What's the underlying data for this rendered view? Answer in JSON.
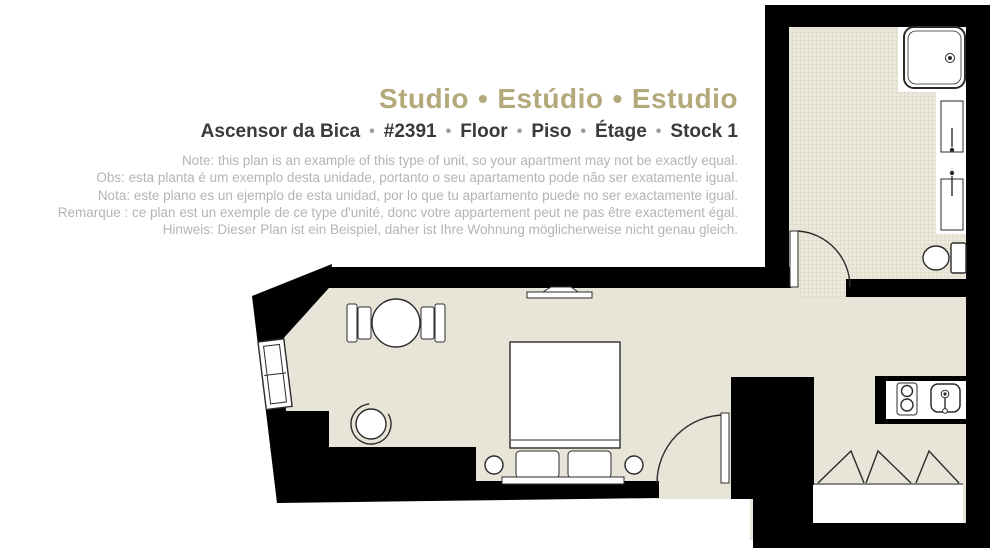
{
  "title": {
    "parts": [
      "Studio",
      "Estúdio",
      "Estudio"
    ],
    "separator": "•"
  },
  "subtitle": {
    "parts": [
      "Ascensor da Bica",
      "#2391",
      "Floor",
      "Piso",
      "Étage",
      "Stock 1"
    ],
    "separator": "•"
  },
  "disclaimer": {
    "lines": [
      "Note: this plan is an example of this type of unit, so your apartment may not be exactly equal.",
      "Obs: esta planta é um exemplo desta unidade, portanto o seu apartamento pode não ser exatamente igual.",
      "Nota: este plano es un ejemplo de esta unidad, por lo que tu apartamento puede no ser exactamente igual.",
      "Remarque : ce plan est un exemple de ce type d'unité, donc votre appartement peut ne pas être exactement égal.",
      "Hinweis: Dieser Plan ist ein Beispiel, daher ist Ihre Wohnung möglicherweise nicht genau gleich."
    ]
  },
  "colors": {
    "accent": "#b3a97b",
    "subtitle_text": "#3a3a3a",
    "separator_gray": "#9b9b9b",
    "disclaimer_gray": "#b4b4b4",
    "wall": "#000000",
    "floor": "#e8e4d8",
    "tile_bg": "#ece9dc",
    "tile_line": "#d6d1bf",
    "line": "#2b2b2b"
  },
  "floorplan": {
    "rooms": [
      "studio-room",
      "bathroom",
      "kitchenette",
      "entrance"
    ],
    "furniture": [
      "window",
      "dining-table",
      "dining-chairs",
      "armchair",
      "wall-radiator",
      "double-bed",
      "pillows",
      "nightstands",
      "entrance-door",
      "bathroom-door",
      "shower-tray",
      "washbasins",
      "toilet",
      "kitchen-counter",
      "hob",
      "kitchen-sink",
      "folding-doors",
      "wardrobe"
    ]
  }
}
